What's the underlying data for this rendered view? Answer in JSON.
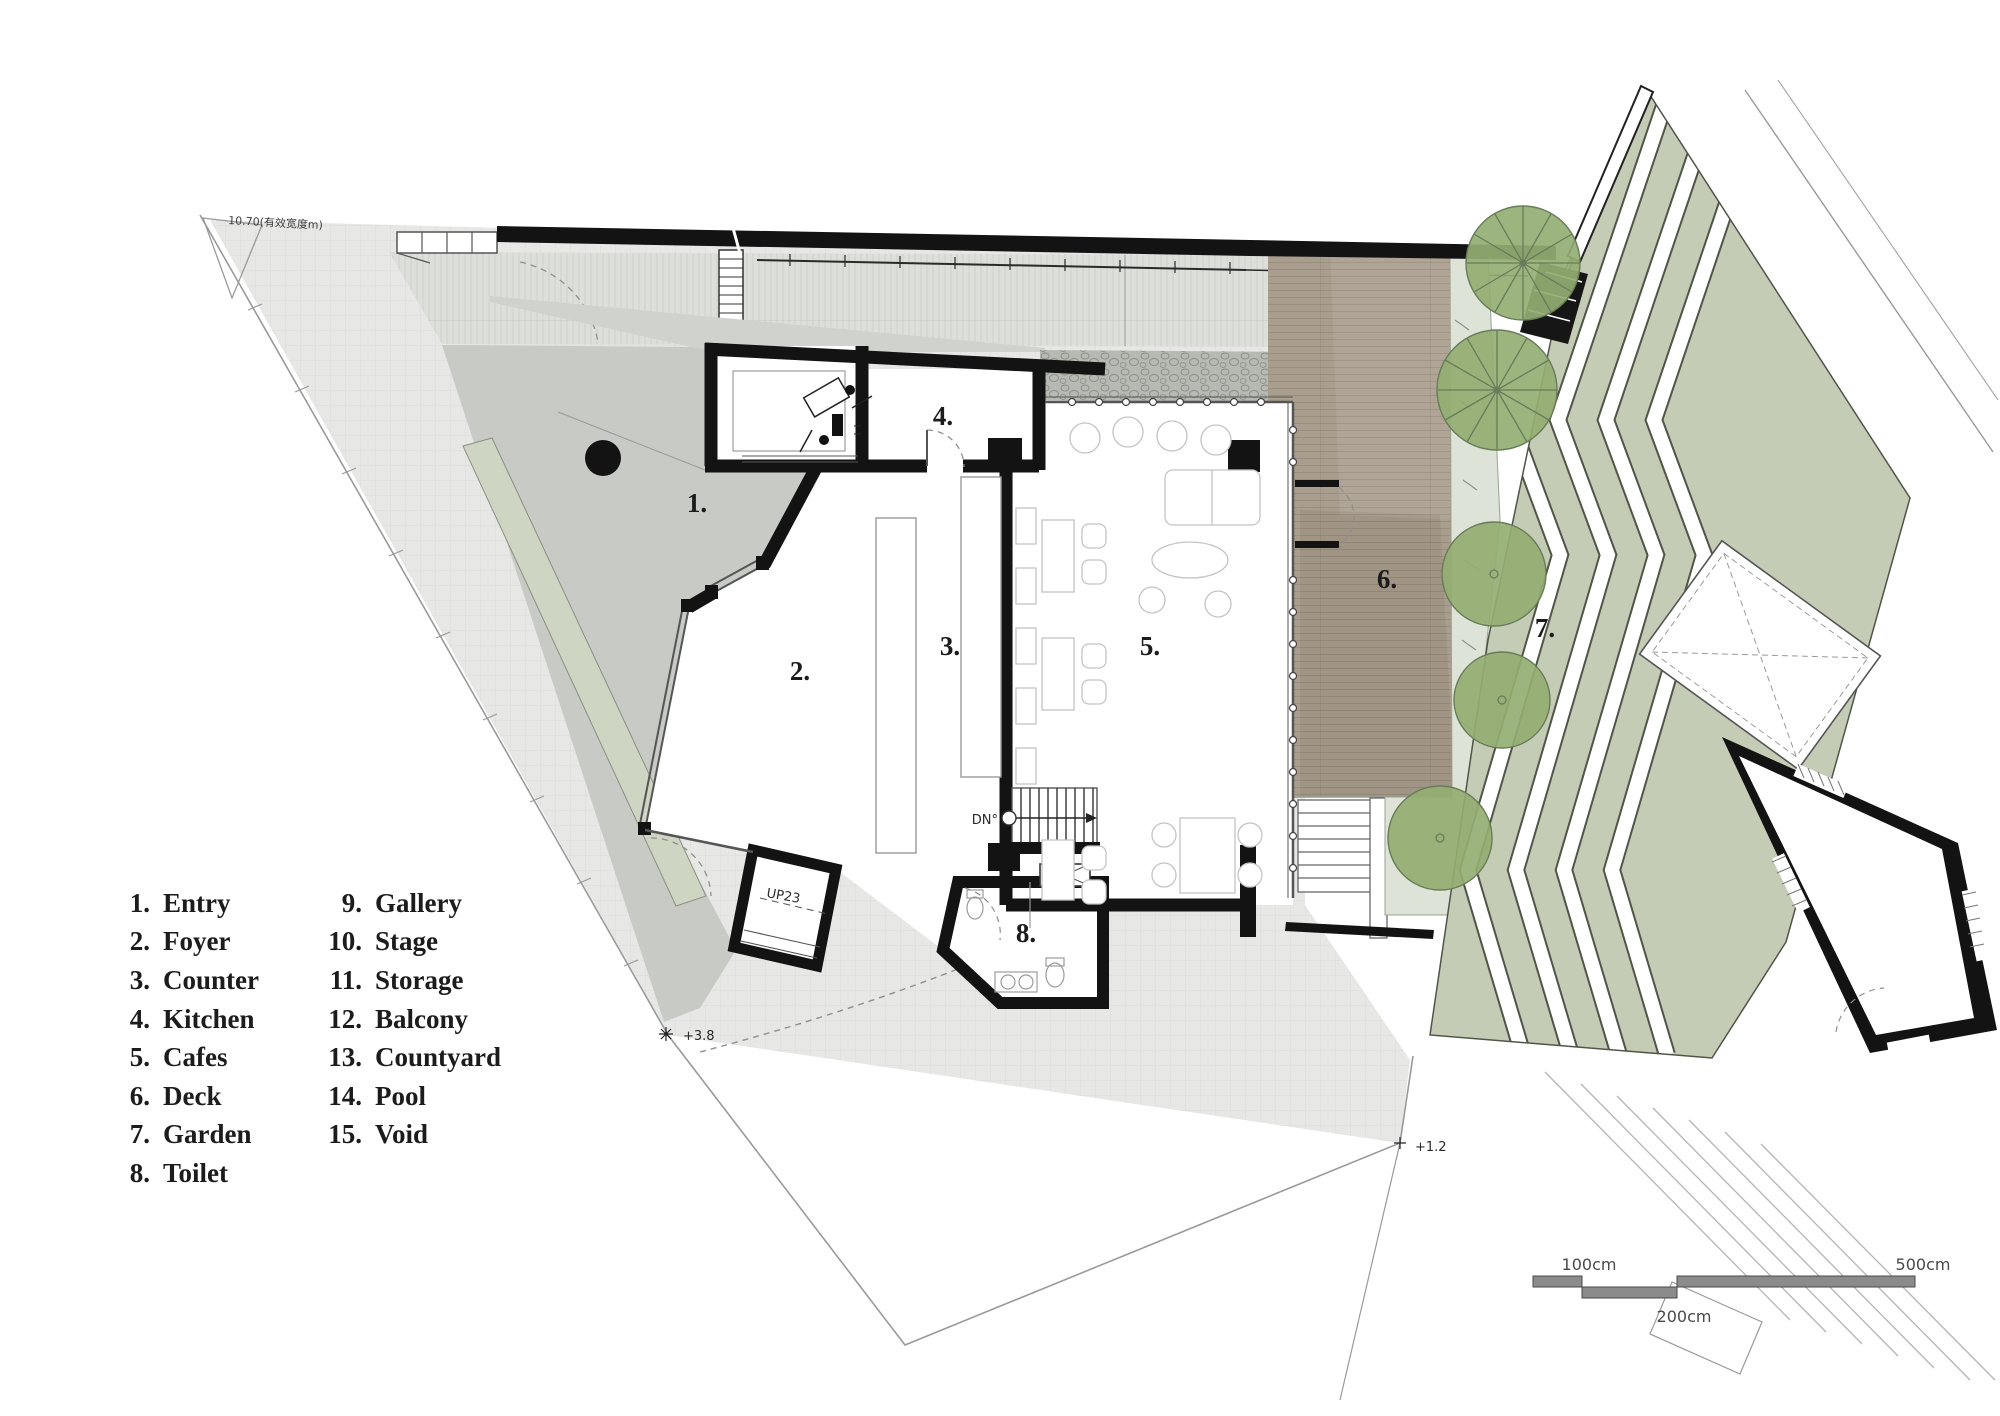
{
  "legend": {
    "items": [
      {
        "num": "1.",
        "label": "Entry"
      },
      {
        "num": "2.",
        "label": "Foyer"
      },
      {
        "num": "3.",
        "label": "Counter"
      },
      {
        "num": "4.",
        "label": "Kitchen"
      },
      {
        "num": "5.",
        "label": "Cafes"
      },
      {
        "num": "6.",
        "label": "Deck"
      },
      {
        "num": "7.",
        "label": "Garden"
      },
      {
        "num": "8.",
        "label": "Toilet"
      },
      {
        "num": "9.",
        "label": "Gallery"
      },
      {
        "num": "10.",
        "label": "Stage"
      },
      {
        "num": "11.",
        "label": "Storage"
      },
      {
        "num": "12.",
        "label": "Balcony"
      },
      {
        "num": "13.",
        "label": "Countyard"
      },
      {
        "num": "14.",
        "label": "Pool"
      },
      {
        "num": "15.",
        "label": "Void"
      }
    ]
  },
  "plan_labels": {
    "entry": "1.",
    "foyer": "2.",
    "counter": "3.",
    "kitchen": "4.",
    "cafes": "5.",
    "deck": "6.",
    "garden": "7.",
    "toilet": "8."
  },
  "annotations": {
    "down": "DN°",
    "up": "UP23",
    "level_a": "+3.8",
    "level_b": "+1.2",
    "boundary_note": "10.70(有效宽度m)"
  },
  "scale_bar": {
    "label_100": "100cm",
    "label_200": "200cm",
    "label_500": "500cm"
  },
  "colors": {
    "site": "#e7e8e5",
    "plaza": "#c8cac5",
    "walkway": "#dddfdb",
    "pebble": "#b7bab3",
    "deck": "#a99e8d",
    "sage": "#c4ccb6",
    "sage_light": "#dde3d6",
    "strip": "#ced5c3",
    "tree": "#94ae72",
    "tree_edge": "#687c5a",
    "wall": "#131313",
    "ink": "#1c1c1c",
    "line": "#555555",
    "scale_bar": "#8b8b8b"
  }
}
